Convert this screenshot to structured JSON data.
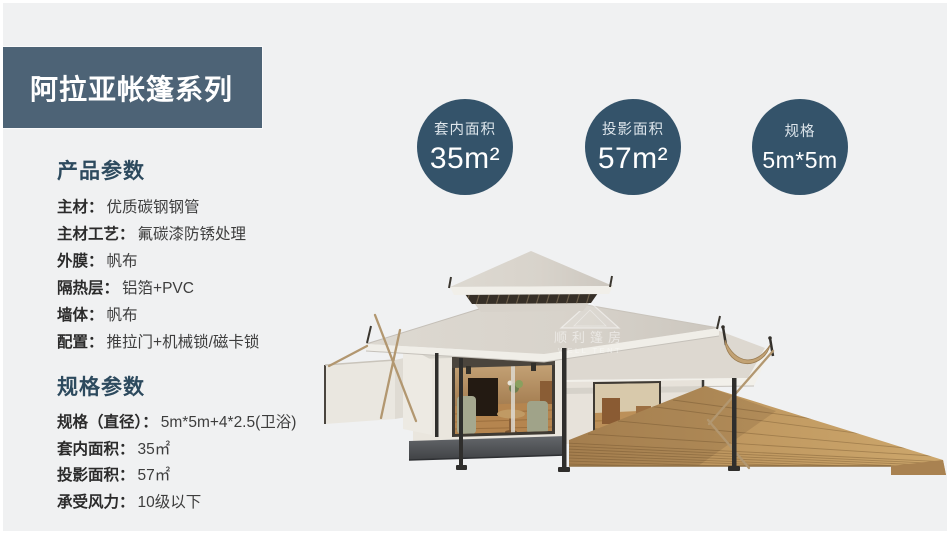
{
  "theme": {
    "bg": "#f0f1f2",
    "header_bg": "#4d6376",
    "badge_bg": "#34536a",
    "heading_color": "#2d4a5e"
  },
  "header": {
    "title": "阿拉亚帐篷系列"
  },
  "badges": [
    {
      "label": "套内面积",
      "value": "35m²"
    },
    {
      "label": "投影面积",
      "value": "57m²"
    },
    {
      "label": "规格",
      "value": "5m*5m"
    }
  ],
  "sections": [
    {
      "heading": "产品参数",
      "rows": [
        {
          "label": "主材：",
          "value": "优质碳钢钢管"
        },
        {
          "label": "主材工艺：",
          "value": "氟碳漆防锈处理"
        },
        {
          "label": "外膜：",
          "value": "帆布"
        },
        {
          "label": "隔热层：",
          "value": "铝箔+PVC"
        },
        {
          "label": "墙体：",
          "value": "帆布"
        },
        {
          "label": "配置：",
          "value": "推拉门+机械锁/磁卡锁"
        }
      ]
    },
    {
      "heading": "规格参数",
      "rows": [
        {
          "label": "规格（直径）：",
          "value": "5m*5m+4*2.5(卫浴)"
        },
        {
          "label": "套内面积：",
          "value": "35㎡"
        },
        {
          "label": "投影面积：",
          "value": "57㎡"
        },
        {
          "label": "承受风力：",
          "value": "10级以下"
        }
      ]
    }
  ],
  "tent": {
    "watermark_cn": "顺利篷房",
    "watermark_en": "WELL TENT"
  }
}
